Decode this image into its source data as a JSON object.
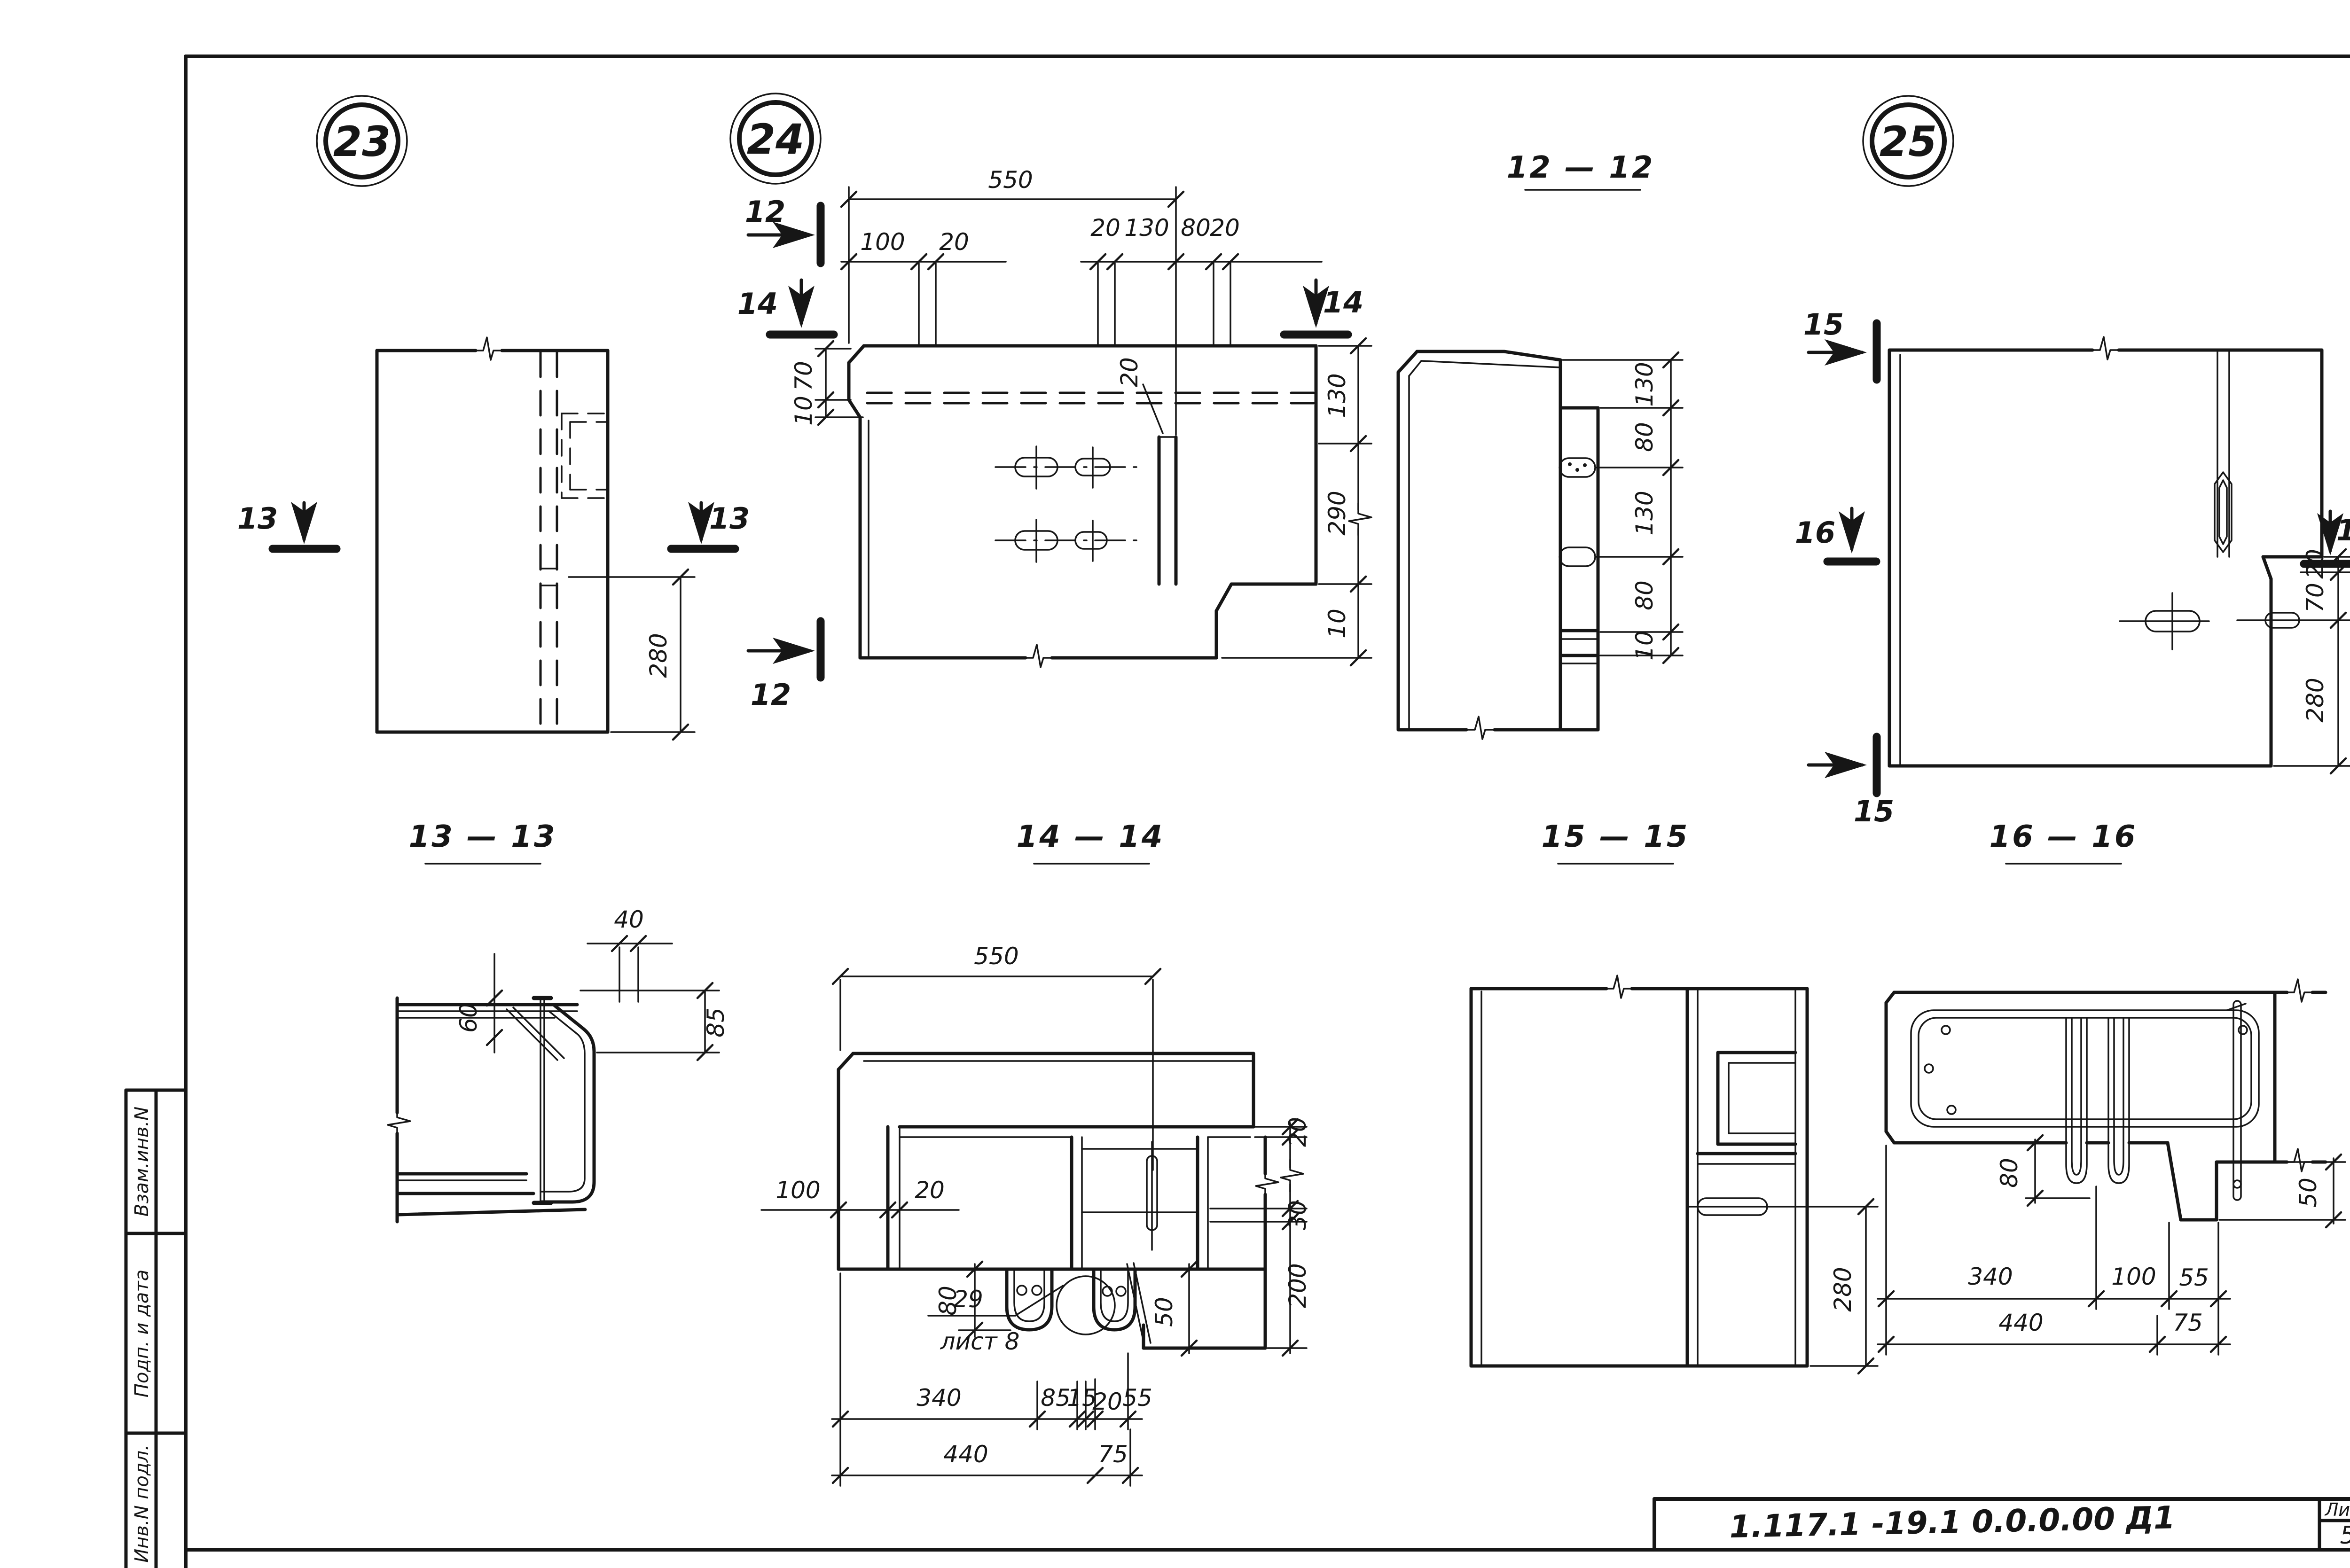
{
  "sheet": {
    "paper_color": "#ffffff",
    "ink_color": "#161616",
    "badges": {
      "b23": "23",
      "b24": "24",
      "b25": "25"
    },
    "sections": {
      "t12": "12 — 12",
      "t13": "13 — 13",
      "t14": "14 — 14",
      "t15": "15 — 15",
      "t16": "16 — 16"
    },
    "cut_marks": {
      "n12": "12",
      "n13": "13",
      "n14": "14",
      "n15": "15",
      "n16": "16"
    },
    "dims": {
      "v23": {
        "h280": "280"
      },
      "v24": {
        "w550": "550",
        "w100": "100",
        "w20a": "20",
        "w20b": "20",
        "w130": "130",
        "w80": "80",
        "w20c": "20",
        "slot20": "20",
        "h70": "70",
        "h10a": "10",
        "h130": "130",
        "h290": "290",
        "h10b": "10"
      },
      "v12": {
        "h130a": "130",
        "h80a": "80",
        "h130b": "130",
        "h80b": "80",
        "h10": "10"
      },
      "v25": {
        "h20": "20",
        "h70": "70",
        "h280": "280"
      },
      "v13": {
        "w40": "40",
        "h60": "60",
        "h85": "85"
      },
      "v14": {
        "w550": "550",
        "w100": "100",
        "w20": "20",
        "h80": "80",
        "h20": "20",
        "h30": "30",
        "h200": "200",
        "h50": "50",
        "w340": "340",
        "w85": "85",
        "w15": "15",
        "w20b": "20",
        "w55": "55",
        "w440": "440",
        "w75": "75"
      },
      "v15": {
        "h280": "280"
      },
      "v16": {
        "h80": "80",
        "h50": "50",
        "w340": "340",
        "w100": "100",
        "w55": "55",
        "w440": "440",
        "w75": "75"
      }
    },
    "callout": {
      "number": "29",
      "sheet_ref": "лист 8"
    },
    "sidebar": {
      "rows": [
        {
          "label": "Взам.инв.N"
        },
        {
          "label": "Подп. и дата"
        },
        {
          "label": "Инв.N подл."
        }
      ]
    },
    "title_block": {
      "doc_number": "1.117.1 -19.1   0.0.0.00 Д1",
      "sheet_label": "Лист",
      "sheet_number": "5"
    }
  }
}
